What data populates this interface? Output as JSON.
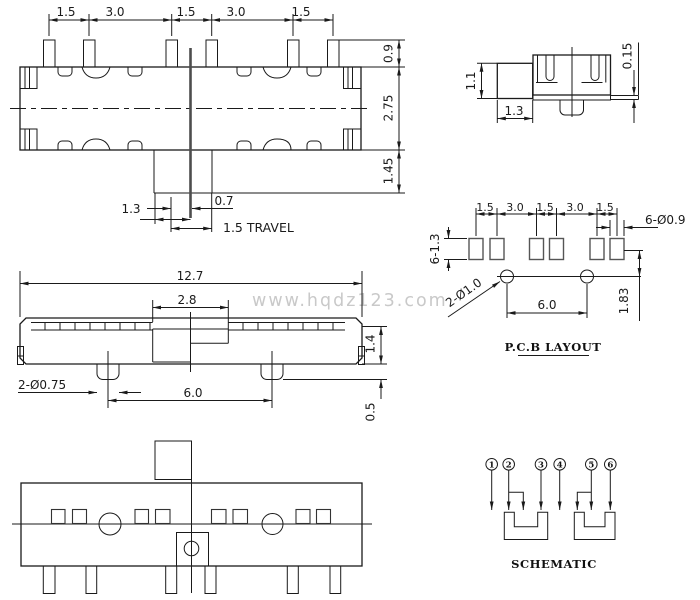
{
  "watermark": "www.hqdz123.com",
  "colors": {
    "line": "#1a1a1a",
    "dark_slider": "#4d4d4d",
    "watermark": "#c9c9c9",
    "background": "#ffffff"
  },
  "front_view": {
    "dims_top": [
      "1.5",
      "3.0",
      "1.5",
      "3.0",
      "1.5"
    ],
    "dim_pin_height": "0.9",
    "dim_body_height": "2.75",
    "dim_slider_height": "1.45",
    "dim_slot_left": "1.3",
    "dim_slot_right": "0.7",
    "dim_travel": "1.5 TRAVEL"
  },
  "side_view": {
    "dim_knob_height": "1.1",
    "dim_knob_width": "1.3",
    "dim_pin_thickness": "0.15"
  },
  "pcb_layout": {
    "title": "P.C.B LAYOUT",
    "dims_top": [
      "1.5",
      "3.0",
      "1.5",
      "3.0",
      "1.5"
    ],
    "dim_pad_holes": "6-Ø0.9",
    "dim_pad_size": "6-1.3",
    "dim_mount_holes": "2-Ø1.0",
    "dim_hole_spacing": "6.0",
    "dim_row_offset": "1.83"
  },
  "top_view": {
    "dim_overall_width": "12.7",
    "dim_slot_width": "2.8",
    "dim_cover_height": "1.4",
    "dim_posts": "2-Ø0.75",
    "dim_post_spacing": "6.0",
    "dim_post_height": "0.5"
  },
  "schematic": {
    "title": "SCHEMATIC",
    "pins": [
      "1",
      "2",
      "3",
      "4",
      "5",
      "6"
    ]
  }
}
